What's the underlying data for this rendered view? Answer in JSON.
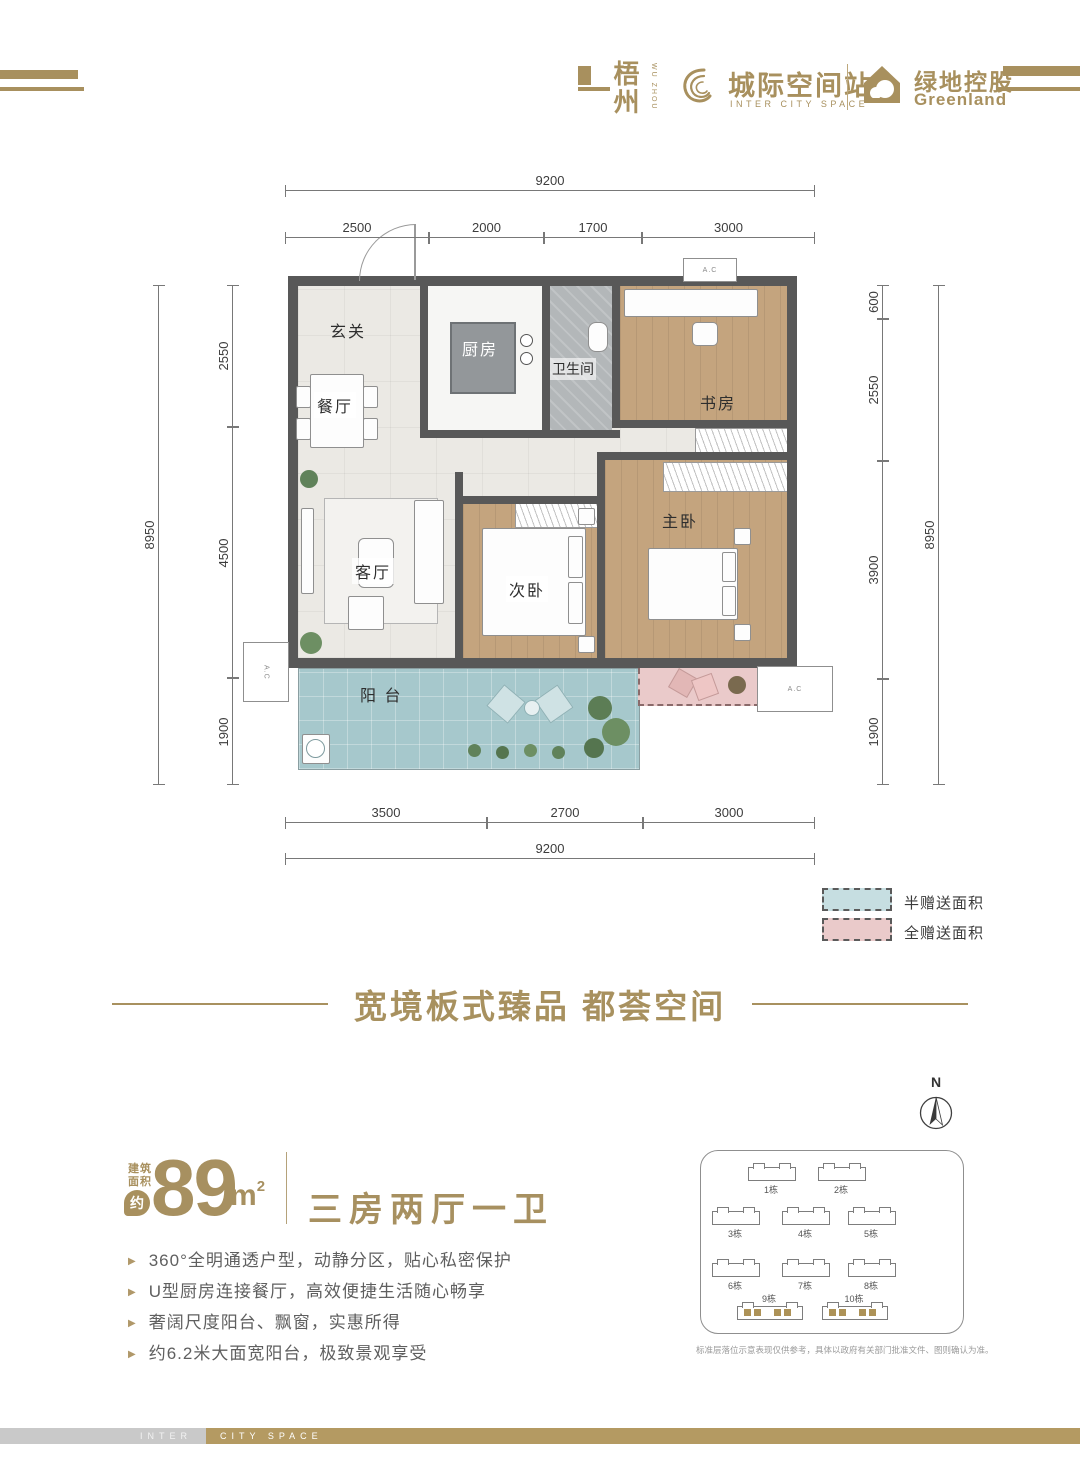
{
  "header": {
    "city": "梧州",
    "city_sub": "WU ZHOU",
    "brand": "城际空间站",
    "brand_sub": "INTER CITY SPACE",
    "developer": "绿地控股",
    "developer_sub": "Greenland"
  },
  "floor_plan": {
    "rooms": {
      "foyer": "玄关",
      "dining": "餐厅",
      "kitchen": "厨房",
      "bath": "卫生间",
      "study": "书房",
      "living": "客厅",
      "bedroom2": "次卧",
      "master": "主卧",
      "balcony": "阳 台"
    },
    "ac_label": "A.C",
    "dimensions": {
      "top_total": "9200",
      "top_segments": [
        "2500",
        "2000",
        "1700",
        "3000"
      ],
      "bottom_segments": [
        "3500",
        "2700",
        "3000"
      ],
      "bottom_total": "9200",
      "left_segments": [
        "2550",
        "4500",
        "1900"
      ],
      "left_total": "8950",
      "right_segments": [
        "600",
        "2550",
        "3900",
        "1900"
      ],
      "right_total": "8950"
    },
    "legend": [
      {
        "label": "半赠送面积",
        "color": "#c6dee1"
      },
      {
        "label": "全赠送面积",
        "color": "#eacaca"
      }
    ]
  },
  "headline": "宽境板式臻品 都荟空间",
  "unit": {
    "area_label_1": "建筑",
    "area_label_2": "面积",
    "approx": "约",
    "area_value": "89",
    "area_unit": "m",
    "area_exp": "2",
    "layout": "三房两厅一卫",
    "features": [
      "360°全明通透户型，动静分区，贴心私密保护",
      "U型厨房连接餐厅，高效便捷生活随心畅享",
      "奢阔尺度阳台、飘窗，实惠所得",
      "约6.2米大面宽阳台，极致景观享受"
    ]
  },
  "compass": {
    "north": "N"
  },
  "site_plan": {
    "buildings": [
      "1栋",
      "2栋",
      "3栋",
      "4栋",
      "5栋",
      "6栋",
      "7栋",
      "8栋",
      "9栋",
      "10栋"
    ],
    "disclaimer": "标准层落位示意表现仅供参考，具体以政府有关部门批准文件、图则确认为准。"
  },
  "footer": {
    "left": "INTER",
    "right": "CITY SPACE"
  },
  "colors": {
    "brand_gold": "#a8905e",
    "balcony_teal": "#a6c8cc",
    "gift_pink": "#eacaca",
    "wood_floor": "#c4a47e",
    "wall_gray": "#585858"
  }
}
